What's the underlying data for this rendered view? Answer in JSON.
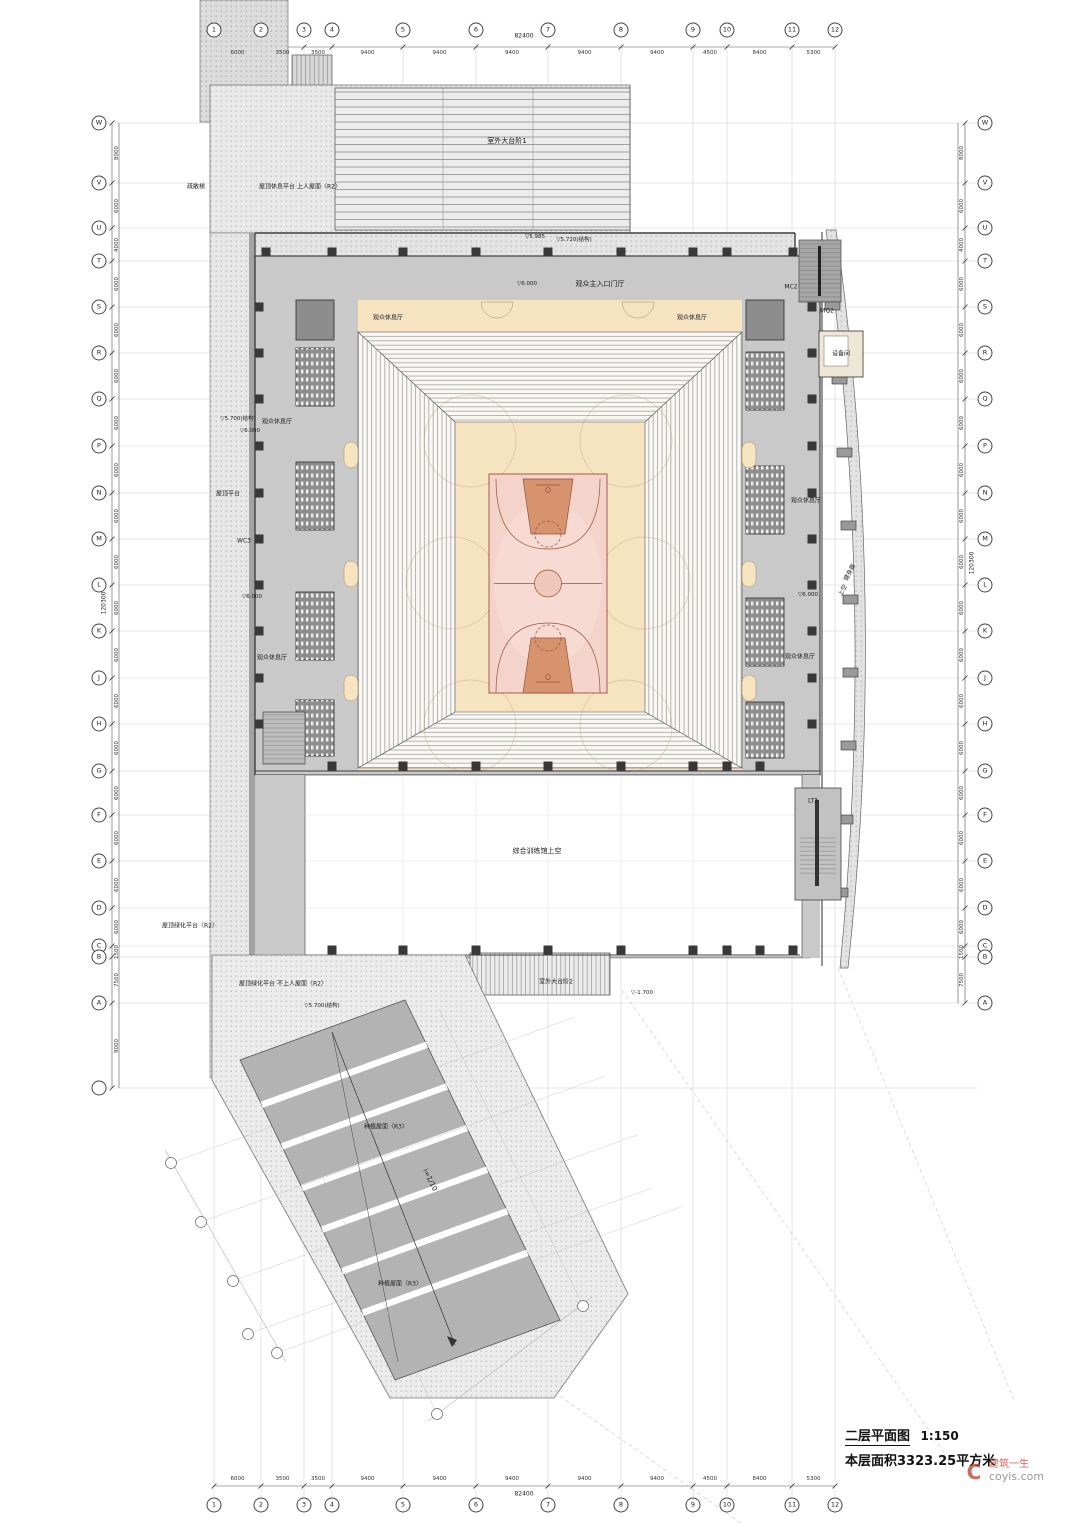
{
  "title_block": {
    "title": "二层平面图",
    "scale": "1:150",
    "area": "本层面积3323.25平方米"
  },
  "watermark": {
    "logo": "C",
    "brand": "建筑一生",
    "site": "coyis.com"
  },
  "grid": {
    "columns": [
      {
        "l": "1",
        "x": 214
      },
      {
        "l": "2",
        "x": 261
      },
      {
        "l": "3",
        "x": 304
      },
      {
        "l": "4",
        "x": 332
      },
      {
        "l": "5",
        "x": 403
      },
      {
        "l": "6",
        "x": 476
      },
      {
        "l": "7",
        "x": 548
      },
      {
        "l": "8",
        "x": 621
      },
      {
        "l": "9",
        "x": 693
      },
      {
        "l": "10",
        "x": 727
      },
      {
        "l": "11",
        "x": 792
      },
      {
        "l": "12",
        "x": 835
      }
    ],
    "col_dims": [
      "6000",
      "3500",
      "3500",
      "9400",
      "9400",
      "9400",
      "9400",
      "9400",
      "4500",
      "8400",
      "5300"
    ],
    "col_total": "82400",
    "rows": [
      {
        "l": "W",
        "y": 123
      },
      {
        "l": "V",
        "y": 183
      },
      {
        "l": "U",
        "y": 228
      },
      {
        "l": "T",
        "y": 261
      },
      {
        "l": "S",
        "y": 307
      },
      {
        "l": "R",
        "y": 353
      },
      {
        "l": "Q",
        "y": 399
      },
      {
        "l": "P",
        "y": 446
      },
      {
        "l": "N",
        "y": 493
      },
      {
        "l": "M",
        "y": 539
      },
      {
        "l": "L",
        "y": 585
      },
      {
        "l": "K",
        "y": 631
      },
      {
        "l": "J",
        "y": 678
      },
      {
        "l": "H",
        "y": 724
      },
      {
        "l": "G",
        "y": 771
      },
      {
        "l": "F",
        "y": 815
      },
      {
        "l": "E",
        "y": 861
      },
      {
        "l": "D",
        "y": 908
      },
      {
        "l": "C",
        "y": 946
      },
      {
        "l": "B",
        "y": 957
      },
      {
        "l": "A",
        "y": 1003
      },
      {
        "l": "",
        "y": 1088,
        "lo": true
      }
    ],
    "row_dims": [
      "8000",
      "6000",
      "4000",
      "6000",
      "6000",
      "6000",
      "6000",
      "6000",
      "6000",
      "6000",
      "6000",
      "6000",
      "6000",
      "6000",
      "6000",
      "6000",
      "6000",
      "6000",
      "1500",
      "7500",
      "9000"
    ],
    "row_total": "120300"
  },
  "colors": {
    "floor_gray": "#c9c9c9",
    "wc_gray": "#8d8d8d",
    "cream": "#f6e3c0",
    "court_pink": "#f3d3ca",
    "key_salmon": "#d6936e",
    "ramp_gray": "#b3b3b3",
    "watermark_red": "#cf4a3a"
  },
  "annotations": [
    {
      "t": "室外大台阶1",
      "x": 507,
      "y": 141,
      "s": 7
    },
    {
      "t": "观众主入口门厅",
      "x": 600,
      "y": 284,
      "s": 7
    },
    {
      "t": "观众休息厅",
      "x": 388,
      "y": 317,
      "s": 6
    },
    {
      "t": "观众休息厅",
      "x": 692,
      "y": 317,
      "s": 6
    },
    {
      "t": "观众休息厅",
      "x": 277,
      "y": 421,
      "s": 6
    },
    {
      "t": "观众休息厅",
      "x": 272,
      "y": 657,
      "s": 6
    },
    {
      "t": "观众休息厅",
      "x": 806,
      "y": 500,
      "s": 6
    },
    {
      "t": "观众休息厅",
      "x": 800,
      "y": 656,
      "s": 6
    },
    {
      "t": "屋顶休息平台 上人屋面〈R2〉",
      "x": 300,
      "y": 186,
      "s": 6
    },
    {
      "t": "疏散梯",
      "x": 196,
      "y": 186,
      "s": 6
    },
    {
      "t": "屋顶平台",
      "x": 228,
      "y": 493,
      "s": 6
    },
    {
      "t": "WC3",
      "x": 244,
      "y": 541,
      "s": 6
    },
    {
      "t": "屋顶绿化平台〈R2〉",
      "x": 190,
      "y": 925,
      "s": 6
    },
    {
      "t": "屋顶绿化平台 不上人屋面〈R2〉",
      "x": 283,
      "y": 983,
      "s": 6
    },
    {
      "t": "MC2",
      "x": 791,
      "y": 287,
      "s": 6
    },
    {
      "t": "MQ2",
      "x": 827,
      "y": 311,
      "s": 6
    },
    {
      "t": "设备间",
      "x": 841,
      "y": 353,
      "s": 6
    },
    {
      "t": "健身廊",
      "x": 849,
      "y": 572,
      "s": 6,
      "r": -62
    },
    {
      "t": "上空",
      "x": 842,
      "y": 590,
      "s": 6,
      "r": -62
    },
    {
      "t": "LT3",
      "x": 813,
      "y": 801,
      "s": 6
    },
    {
      "t": "综合训练馆上空",
      "x": 537,
      "y": 851,
      "s": 7
    },
    {
      "t": "室外大台阶2",
      "x": 556,
      "y": 981,
      "s": 6
    },
    {
      "t": "种植屋面〈R3〉",
      "x": 386,
      "y": 1126,
      "s": 6
    },
    {
      "t": "种植屋面〈R3〉",
      "x": 400,
      "y": 1283,
      "s": 6
    },
    {
      "t": "i=1/10",
      "x": 430,
      "y": 1180,
      "s": 7,
      "r": 64
    },
    {
      "t": "▽5.985",
      "x": 535,
      "y": 237,
      "s": 5.5
    },
    {
      "t": "▽5.720(结构)",
      "x": 574,
      "y": 239,
      "s": 5.5
    },
    {
      "t": "▽6.000",
      "x": 527,
      "y": 284,
      "s": 5.5
    },
    {
      "t": "▽5.700(结构)",
      "x": 238,
      "y": 418,
      "s": 5.5
    },
    {
      "t": "▽6.000",
      "x": 250,
      "y": 431,
      "s": 5.5
    },
    {
      "t": "▽6.000",
      "x": 252,
      "y": 597,
      "s": 5.5
    },
    {
      "t": "▽6.000",
      "x": 808,
      "y": 595,
      "s": 5.5
    },
    {
      "t": "▽-1.700",
      "x": 642,
      "y": 993,
      "s": 5.5
    },
    {
      "t": "▽5.700(结构)",
      "x": 322,
      "y": 1005,
      "s": 5.5
    }
  ]
}
